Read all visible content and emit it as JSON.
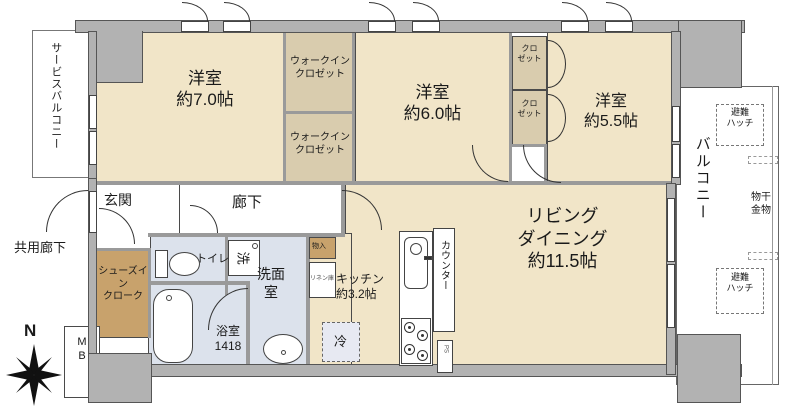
{
  "plan_title": "3LDK apartment floor plan",
  "compass": {
    "north_label": "N"
  },
  "exterior": {
    "service_balcony": "サービスバルコニー",
    "common_corridor": "共用廊下",
    "balcony": "バルコニー",
    "laundry_hardware_line1": "物干",
    "laundry_hardware_line2": "金物",
    "hatch_top_line1": "避難",
    "hatch_top_line2": "ハッチ",
    "hatch_bottom_line1": "避難",
    "hatch_bottom_line2": "ハッチ",
    "meter_box_line1": "M",
    "meter_box_line2": "B"
  },
  "rooms": {
    "bedroom1": {
      "name": "洋室",
      "size": "約7.0帖"
    },
    "bedroom2": {
      "name": "洋室",
      "size": "約6.0帖"
    },
    "bedroom3": {
      "name": "洋室",
      "size": "約5.5帖"
    },
    "living_dining": {
      "line1": "リビング",
      "line2": "ダイニング",
      "size": "約11.5帖"
    },
    "kitchen": {
      "name": "キッチン",
      "size": "約3.2帖"
    },
    "wic1": {
      "line1": "ウォークイン",
      "line2": "クロゼット"
    },
    "wic2": {
      "line1": "ウォークイン",
      "line2": "クロゼット"
    },
    "closet1": {
      "line1": "クロ",
      "line2": "ゼット"
    },
    "closet2": {
      "line1": "クロ",
      "line2": "ゼット"
    },
    "entrance": "玄関",
    "hallway": "廊下",
    "shoes_closet": {
      "line1": "シューズイ",
      "line2": "ン",
      "line3": "クローク"
    },
    "toilet": "トイレ",
    "washroom": {
      "line1": "洗面",
      "line2": "室"
    },
    "bathroom": {
      "name": "浴室",
      "size": "1418"
    },
    "storage": "物入",
    "linen": "リネン庫",
    "counter": "カウンター",
    "fridge": "冷",
    "washer": "洗",
    "pipe_space": "PS"
  }
}
